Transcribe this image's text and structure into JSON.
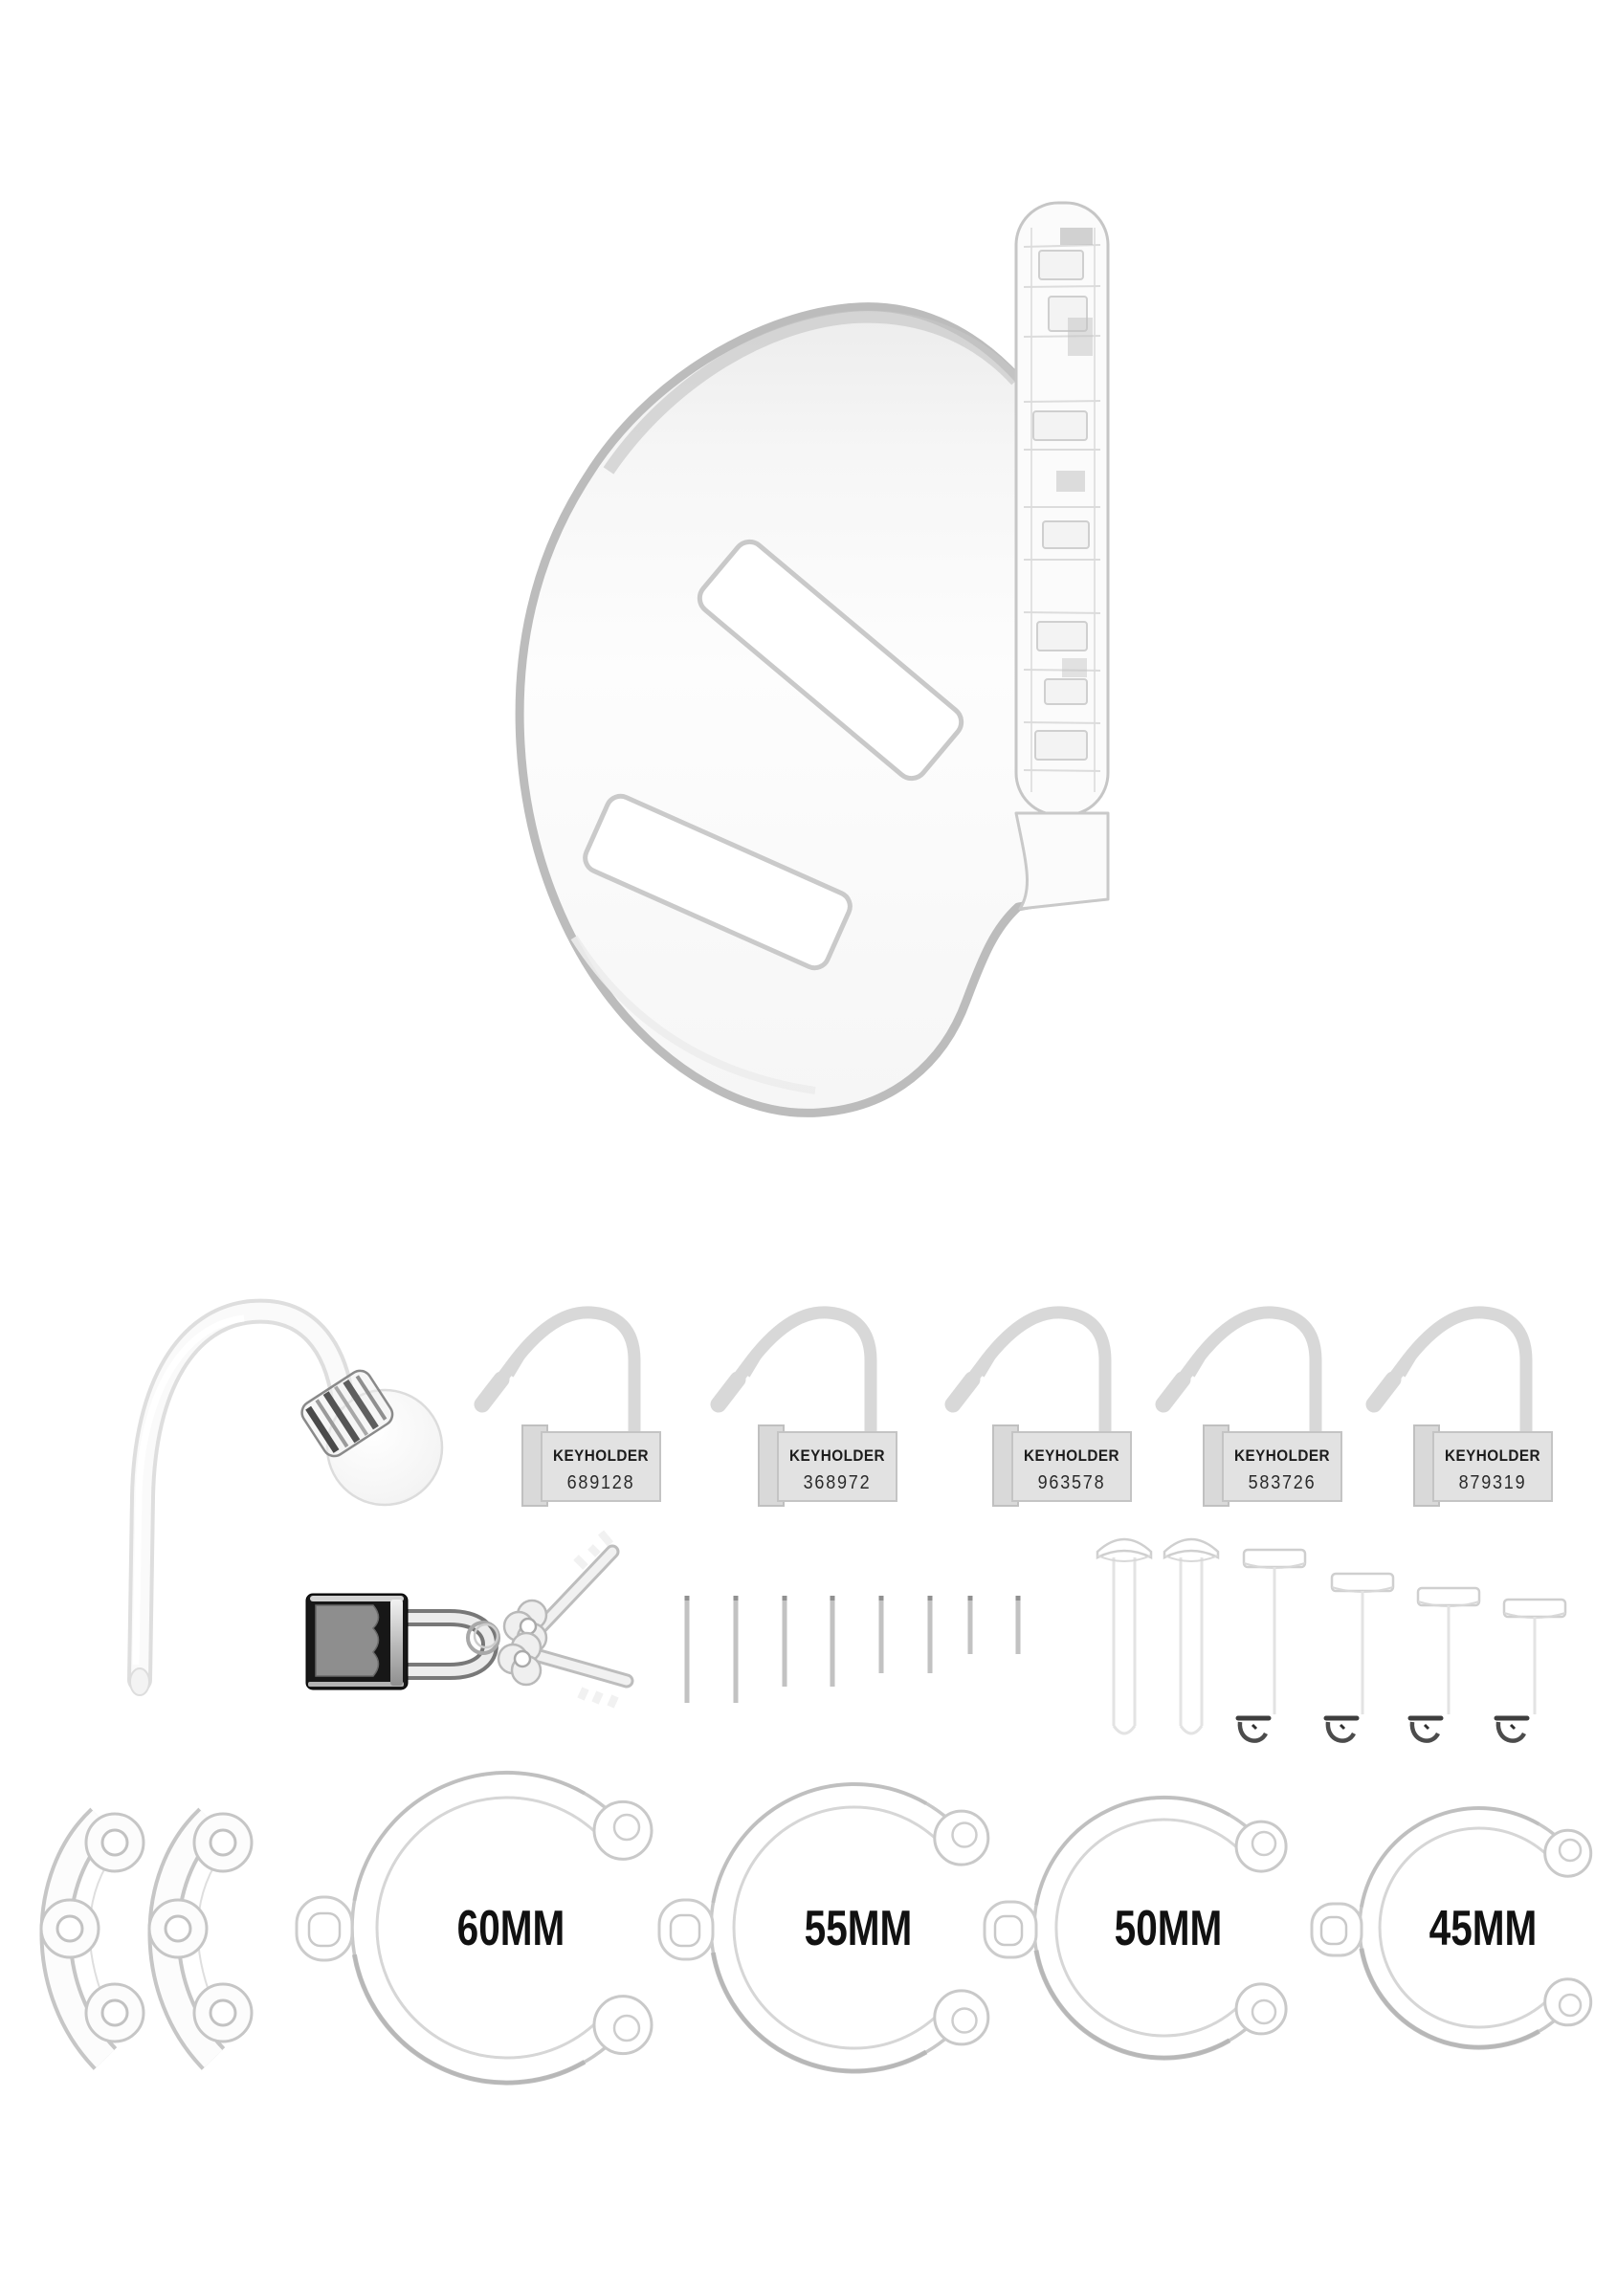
{
  "kit": {
    "keyholder_locks": [
      {
        "label": "KEYHOLDER",
        "number": "689128"
      },
      {
        "label": "KEYHOLDER",
        "number": "368972"
      },
      {
        "label": "KEYHOLDER",
        "number": "963578"
      },
      {
        "label": "KEYHOLDER",
        "number": "583726"
      },
      {
        "label": "KEYHOLDER",
        "number": "879319"
      }
    ],
    "size_rings": [
      {
        "label": "60MM"
      },
      {
        "label": "55MM"
      },
      {
        "label": "50MM"
      },
      {
        "label": "45MM"
      }
    ]
  },
  "colors": {
    "background": "#ffffff",
    "outline_gray": "#c6c6c6",
    "lock_label_bg": "#e2e2e2",
    "label_text": "#1c1c1c",
    "padlock_body": "#171717",
    "padlock_panel": "#8e8e8e"
  }
}
